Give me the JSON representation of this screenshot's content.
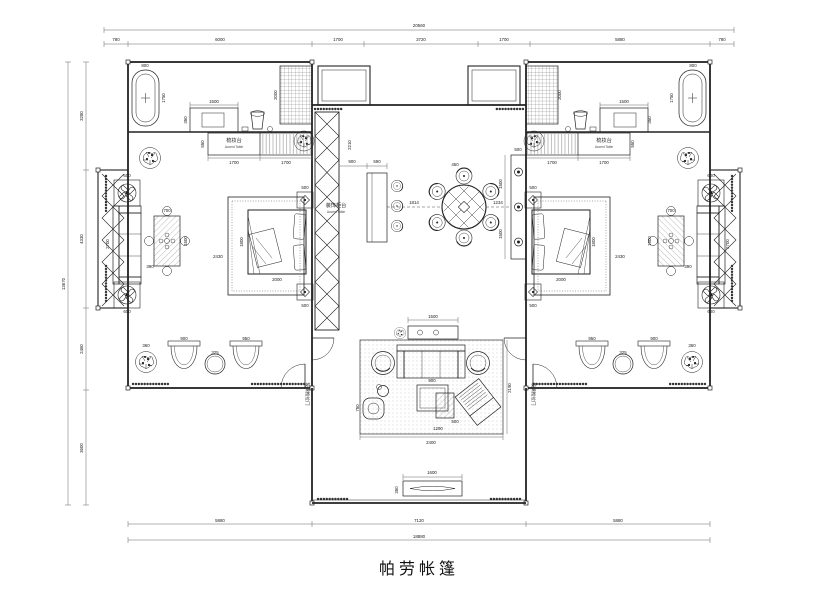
{
  "title": {
    "text": "帕劳帐篷"
  },
  "dims": {
    "top": {
      "total": "20560",
      "seg": [
        "780",
        "6000",
        "1700",
        "3720",
        "1700",
        "5880",
        "780"
      ]
    },
    "left": {
      "total": "13670",
      "seg": [
        "3280",
        "4330",
        "2460",
        "3600"
      ]
    },
    "bottom": {
      "total": "18880",
      "seg": [
        "5880",
        "7120",
        "5880"
      ]
    }
  },
  "labels": {
    "dressing_cn": "梳妆台",
    "dressing_en": "Accent Table",
    "hall_cabinet_cn": "装饰柜台",
    "hall_cabinet_en": "Accent Table",
    "corridor_note": "玻璃推拉门"
  },
  "furniture_dims": {
    "tub_w": "800",
    "tub_l": "1750",
    "vanity_w": "1500",
    "vanity_d": "350",
    "wardrobe_h": "2000",
    "counter_a": "1700",
    "counter_b": "1700",
    "counter_d": "550",
    "bed_w": "1800",
    "bed_l": "2000",
    "nightstand": "500",
    "bed_clear": "2430",
    "porch_sofa": "2700",
    "fan_table": "600",
    "porch_table_w": "700",
    "porch_table_l": "1500",
    "porch_gap": "390",
    "deck_chair_a": "900",
    "deck_chair_b": "950",
    "deck_table": "325",
    "deck_plant": "360",
    "bar_gap": "900",
    "bar_w": "590",
    "screen_h": "2210",
    "table_chair": "450",
    "span_bar_table": "1814",
    "span_table_console": "1234",
    "console_w": "500",
    "console_seg": "1500",
    "sofa_console": "1500",
    "rug_w": "2400",
    "rug_d": "2190",
    "coffee_w": "1290",
    "coffee_d": "900",
    "coffee_inner": "500",
    "side_table": "750",
    "bench_w": "1600",
    "bench_d": "350"
  }
}
